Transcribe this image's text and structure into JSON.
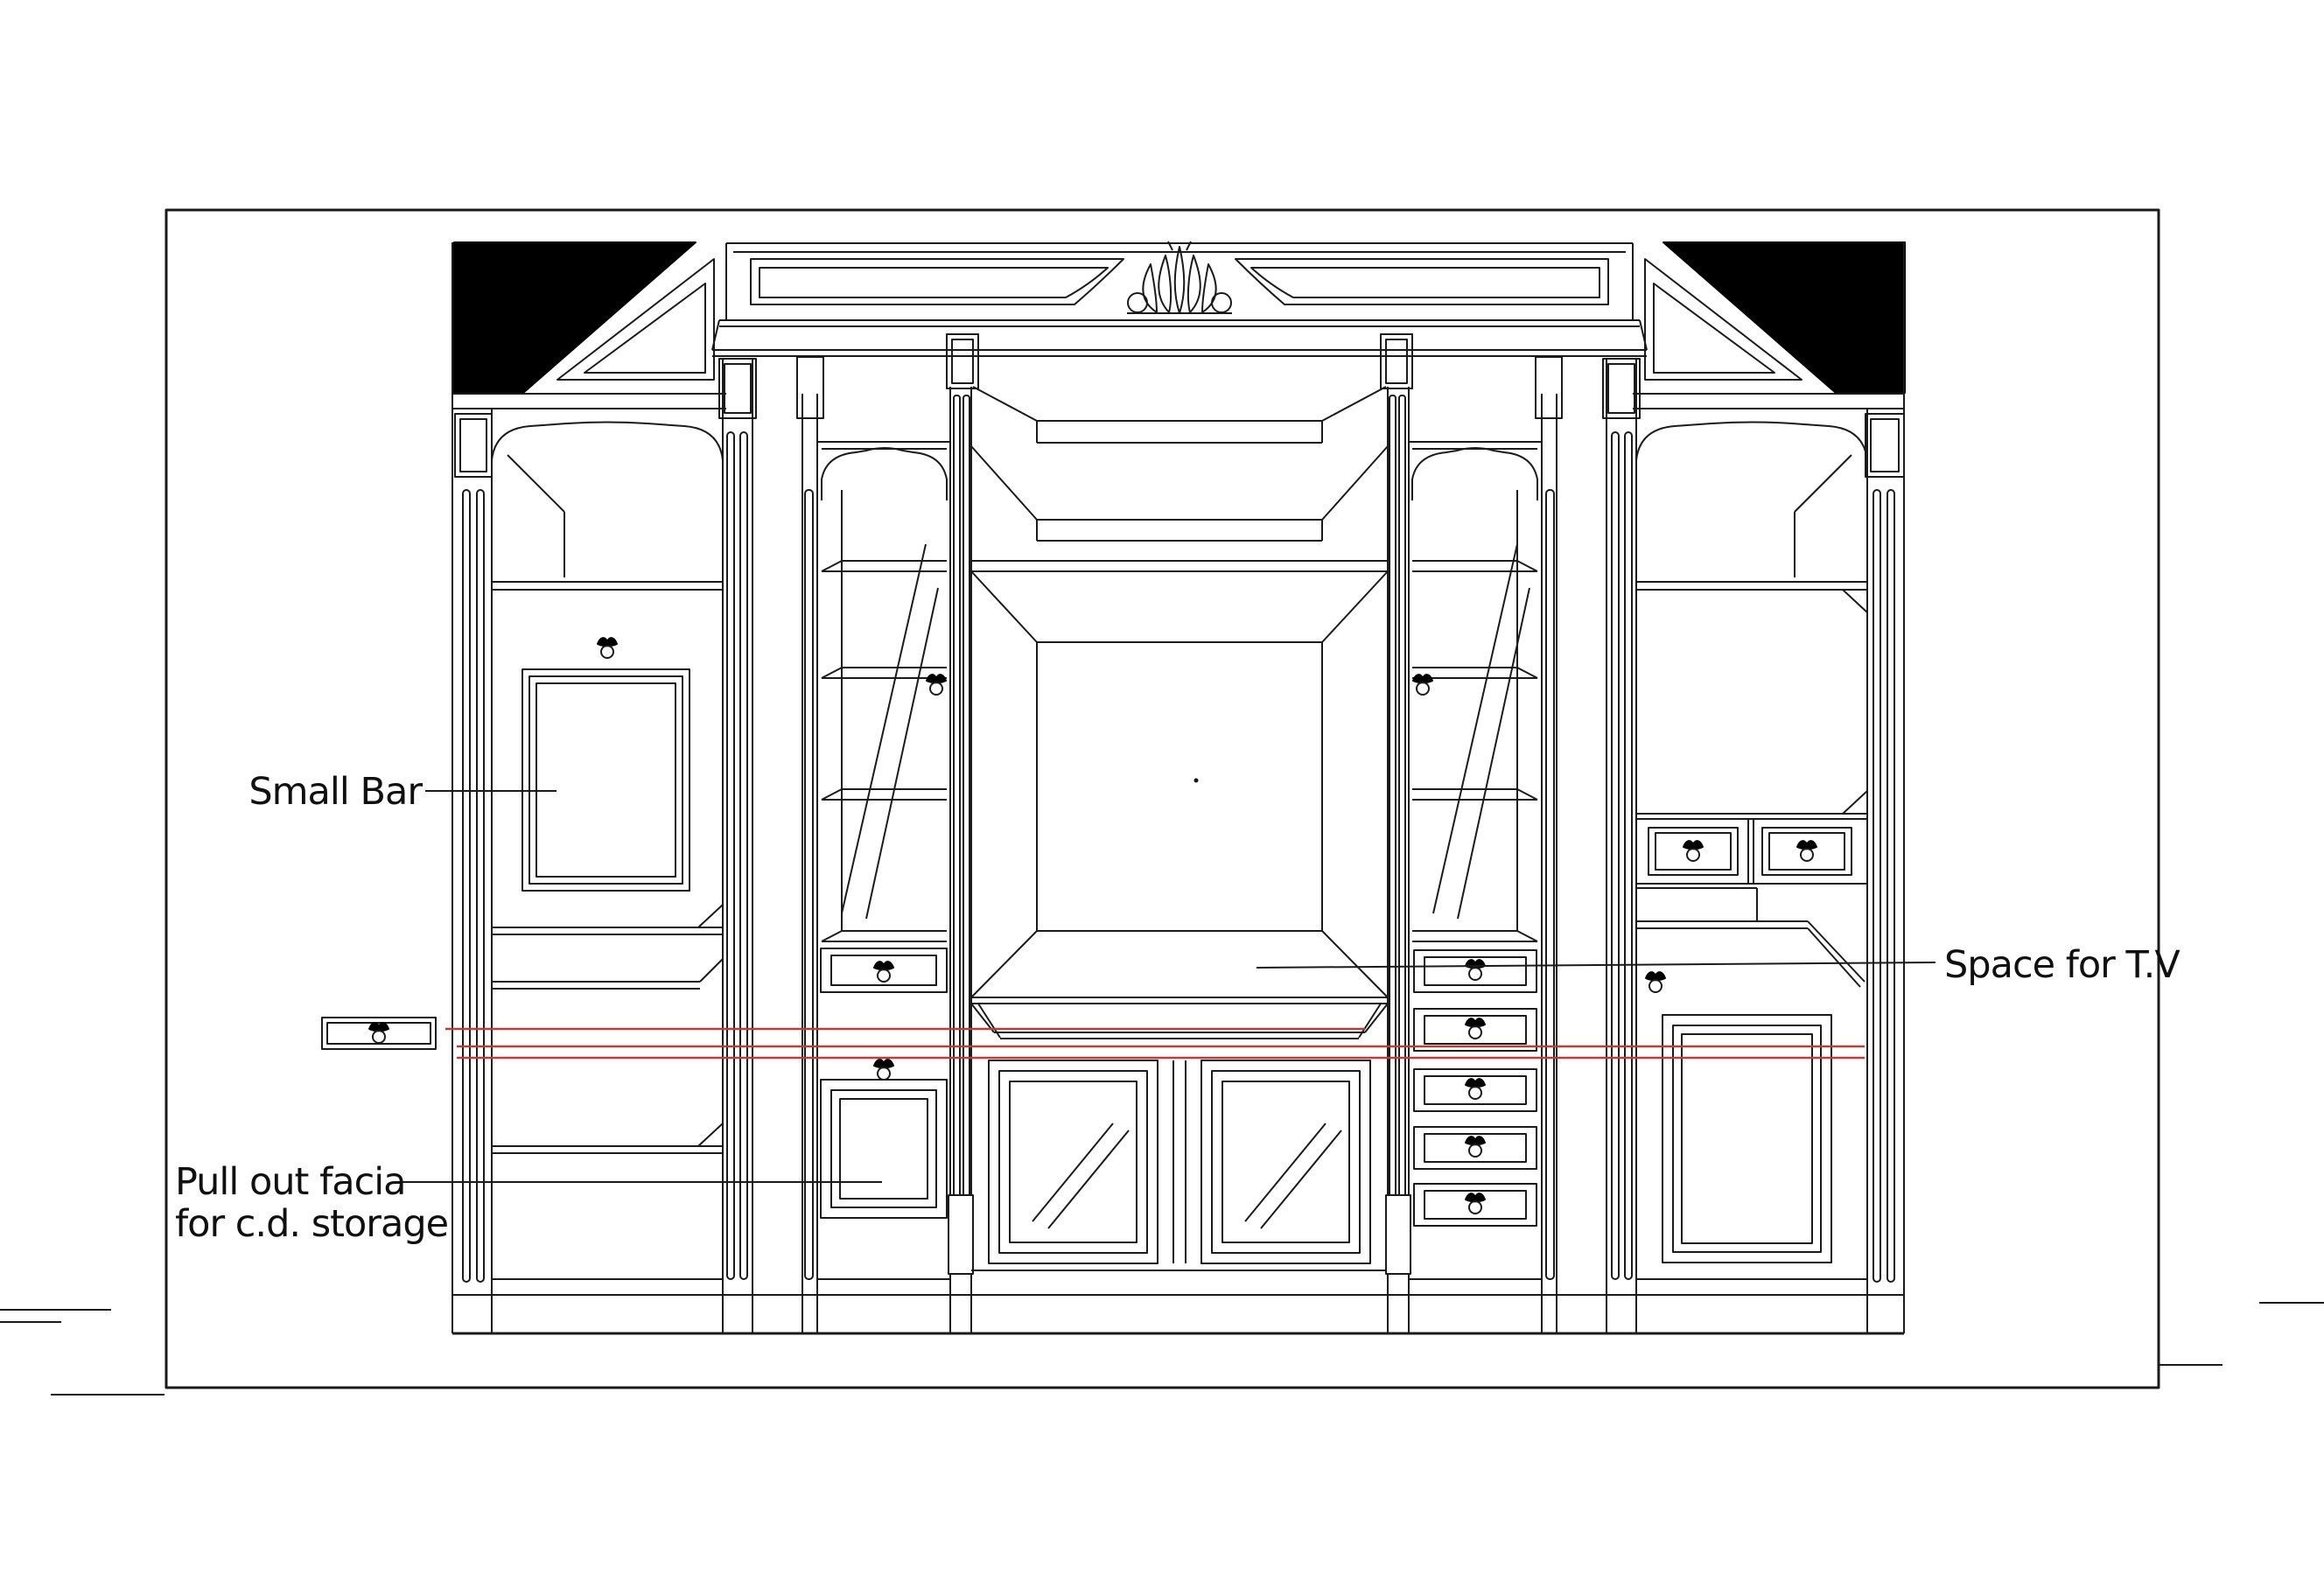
{
  "document": {
    "type": "cabinet elevation CAD drawing",
    "background_color": "#ffffff",
    "line_color": "#1b1b1b",
    "highlight_line_color": "#bf3a3a"
  },
  "annotations": {
    "small_bar": "Small Bar",
    "pull_out_facia_line1": "Pull out facia",
    "pull_out_facia_line2": "for c.d. storage",
    "space_for_tv": "Space for T.V"
  }
}
